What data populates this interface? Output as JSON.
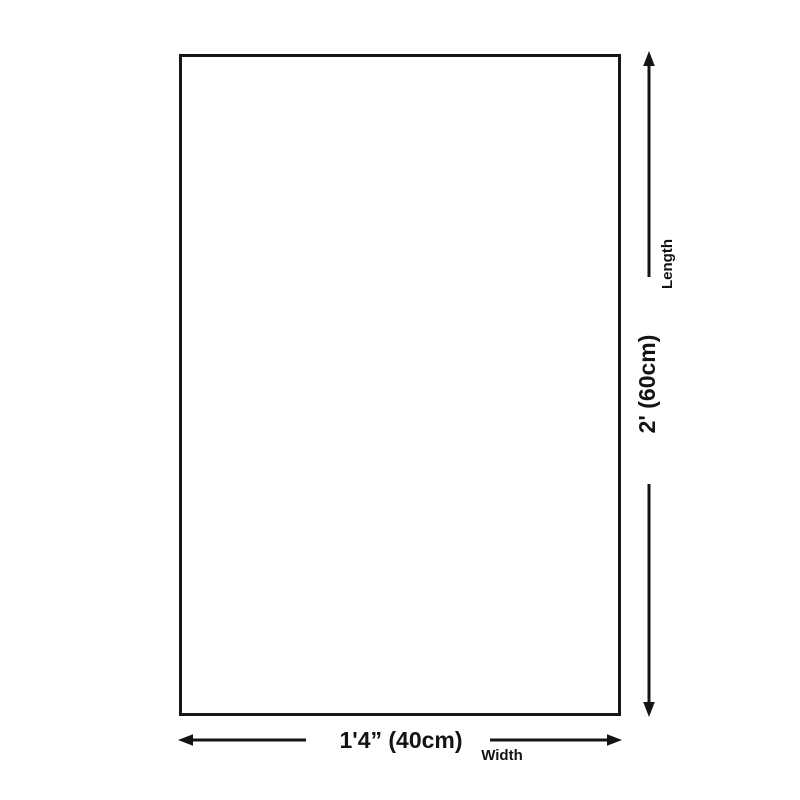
{
  "colors": {
    "line": "#141414",
    "background": "#ffffff"
  },
  "dimensions": {
    "length": {
      "value": "2' (60cm)",
      "label": "Length"
    },
    "width": {
      "value": "1'4” (40cm)",
      "label": "Width"
    }
  }
}
